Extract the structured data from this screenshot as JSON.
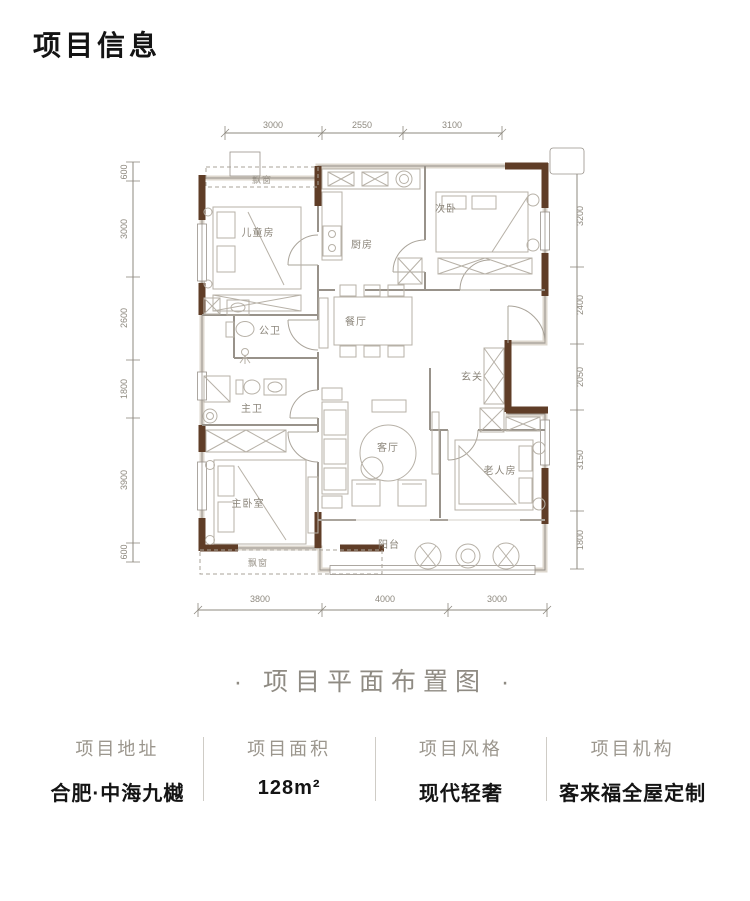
{
  "page": {
    "title": "项目信息",
    "subtitle": "· 项目平面布置图 ·"
  },
  "plan": {
    "rooms": {
      "bay_top": "飘窗",
      "children": "儿童房",
      "kitchen": "厨房",
      "bedroom2": "次卧",
      "dining": "餐厅",
      "bath_public": "公卫",
      "bath_master": "主卫",
      "foyer": "玄关",
      "living": "客厅",
      "master": "主卧室",
      "elder": "老人房",
      "balcony": "阳台",
      "bay_bottom": "飘窗"
    },
    "dims": {
      "top": [
        "3000",
        "2550",
        "3100"
      ],
      "left": [
        "600",
        "3000",
        "2600",
        "1800",
        "3900",
        "600"
      ],
      "right": [
        "3200",
        "2400",
        "2050",
        "3150",
        "1800"
      ],
      "bottom": [
        "3800",
        "4000",
        "3000"
      ]
    },
    "colors": {
      "wall_brown": "#5f3d27",
      "line_gray": "#98928a",
      "dim_gray": "#8e897f"
    }
  },
  "info": {
    "columns": [
      {
        "label": "项目地址",
        "value": "合肥·中海九樾"
      },
      {
        "label": "项目面积",
        "value": "128m²"
      },
      {
        "label": "项目风格",
        "value": "现代轻奢"
      },
      {
        "label": "项目机构",
        "value": "客来福全屋定制"
      }
    ]
  }
}
